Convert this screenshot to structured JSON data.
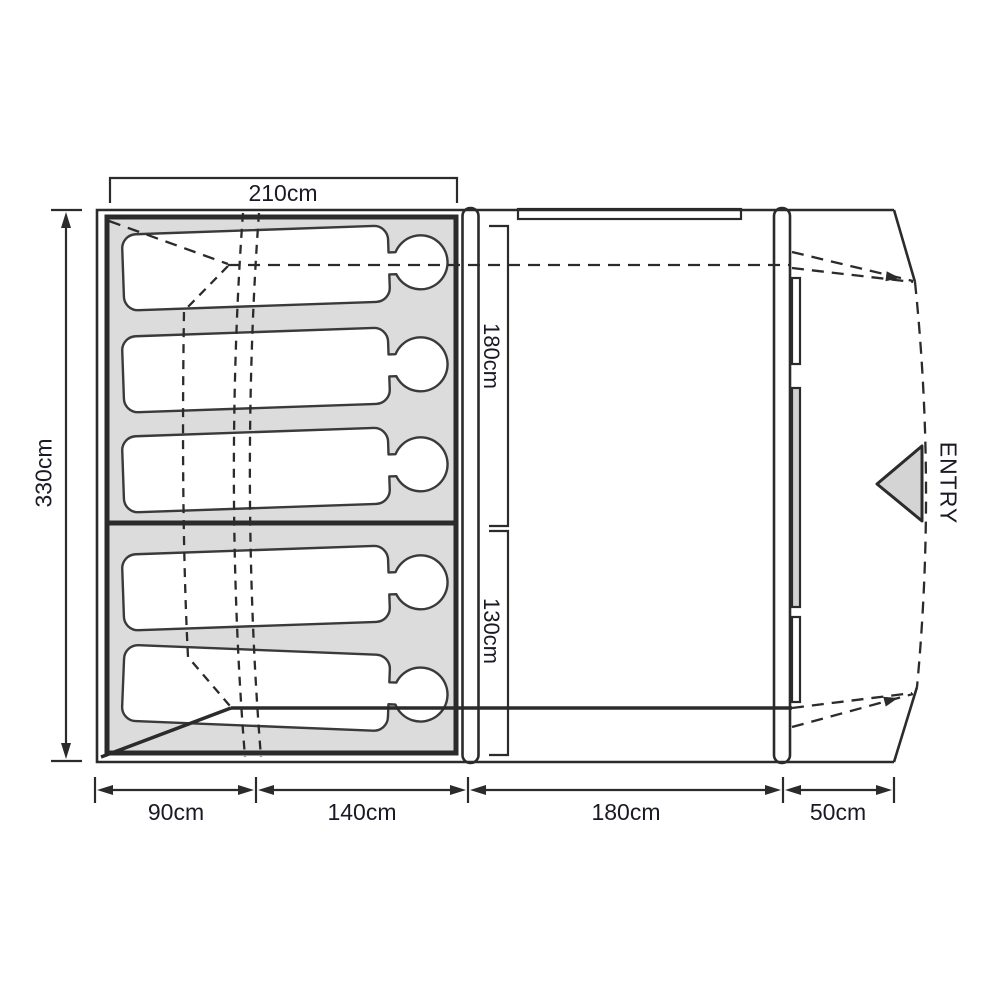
{
  "floorplan": {
    "type": "tent-floor-plan",
    "labels": {
      "top_width": "210cm",
      "left_depth": "330cm",
      "upper_room_depth": "180cm",
      "lower_room_depth": "130cm",
      "bottom_seg_1": "90cm",
      "bottom_seg_2": "140cm",
      "bottom_seg_3": "180cm",
      "bottom_seg_4": "50cm",
      "entry": "ENTRY"
    },
    "sleeping_area": {
      "occupant_count": 5,
      "upper_compartment_occupants": 3,
      "lower_compartment_occupants": 2
    },
    "colors": {
      "line": "#2b2b2b",
      "bedroom_fill": "#dcdcdc",
      "panel_fill": "#d2d2d2",
      "entry_arrow_fill": "#d4d4d4",
      "label_text": "#1a1a26",
      "background": "#ffffff"
    }
  }
}
